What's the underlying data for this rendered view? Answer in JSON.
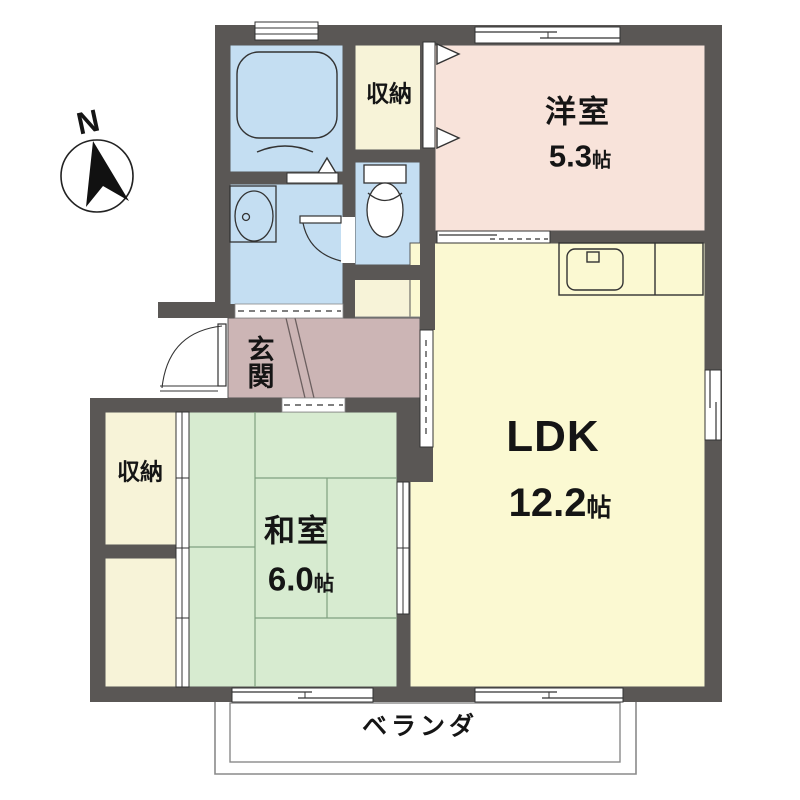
{
  "plan_title": "apartment floor plan",
  "compass": {
    "north_label": "N"
  },
  "rooms": {
    "yoshitsu": {
      "name": "洋室",
      "size": "5.3",
      "unit": "帖"
    },
    "ldk": {
      "name": "LDK",
      "size": "12.2",
      "unit": "帖"
    },
    "washitsu": {
      "name": "和室",
      "size": "6.0",
      "unit": "帖"
    },
    "closet_top": {
      "name": "収納"
    },
    "closet_left": {
      "name": "収納"
    },
    "genkan": {
      "name": "玄関"
    },
    "veranda": {
      "name": "ベランダ"
    }
  },
  "fixtures": [
    "bathtub",
    "washbasin",
    "toilet",
    "kitchen-sink",
    "entrance-door",
    "washroom-door"
  ],
  "colors": {
    "wall": "#5a5755",
    "yoshitsu": "#f8e3da",
    "ldk": "#fbf9d2",
    "washitsu": "#d7ebd0",
    "closet": "#f7f3d8",
    "wet_area": "#c4def2",
    "genkan": "#ccb5b5",
    "line": "#333333"
  }
}
